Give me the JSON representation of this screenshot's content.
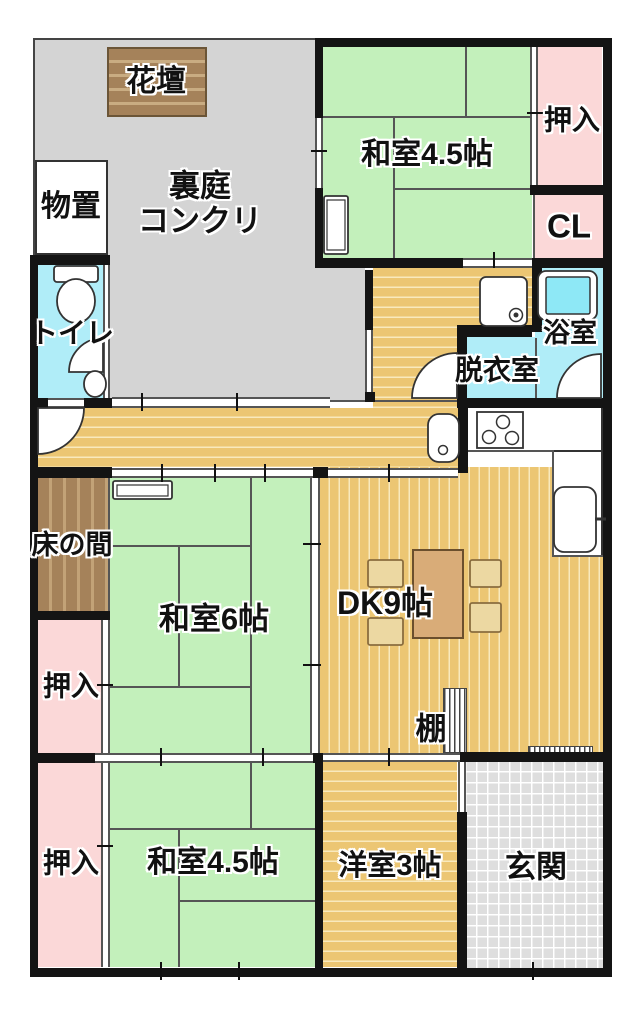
{
  "meta": {
    "type": "floor-plan",
    "description": "Japanese apartment floor plan"
  },
  "colors": {
    "tatami_green": "#c3f0bb",
    "closet_pink": "#fbd8d8",
    "wet_cyan": "#b0edf8",
    "wood_tan": "#ecc673",
    "wood_stripe": "#f9e9bd",
    "garden_gray": "#d4d4d4",
    "entry_gray": "#dedede",
    "alcove_brown": "#a5825a",
    "wall_black": "#141414",
    "table_brown": "#d9ac78",
    "chair_tan": "#ecd8a2"
  },
  "icons": [
    "toilet-icon",
    "hand-basin-icon",
    "door-arc-icon",
    "washbasin-icon",
    "stove-icon",
    "washing-machine-pan-icon",
    "bathtub-icon",
    "refrigerator-icon",
    "air-conditioner-icon",
    "dining-table-icon",
    "chair-icon",
    "shelf-icon"
  ],
  "rooms": [
    {
      "name": "backyard-area",
      "fill": "garden",
      "rect": [
        33,
        38,
        289,
        362
      ]
    },
    {
      "name": "backyard-area-east",
      "fill": "garden2",
      "rect": [
        322,
        268,
        43,
        132
      ]
    },
    {
      "name": "flower-bed",
      "fill": "bed",
      "rect": [
        107,
        47,
        100,
        70
      ]
    },
    {
      "name": "storage-shed",
      "fill": "white",
      "rect": [
        35,
        160,
        73,
        95
      ]
    },
    {
      "name": "toilet-room",
      "fill": "wet",
      "rect": [
        38,
        265,
        65,
        133
      ]
    },
    {
      "name": "laundry-area",
      "fill": "wood-h",
      "rect": [
        373,
        268,
        159,
        57
      ]
    },
    {
      "name": "kitchen-corridor",
      "fill": "wood-h",
      "rect": [
        373,
        268,
        84,
        140
      ]
    },
    {
      "name": "dressing-room",
      "fill": "wet",
      "rect": [
        467,
        337,
        68,
        61
      ]
    },
    {
      "name": "bathroom",
      "fill": "wet",
      "rect": [
        535,
        268,
        68,
        130
      ]
    },
    {
      "name": "hallway",
      "fill": "wood-h",
      "rect": [
        38,
        408,
        422,
        59
      ]
    },
    {
      "name": "dining-kitchen",
      "fill": "wood-v",
      "rect": [
        320,
        467,
        283,
        286
      ]
    },
    {
      "name": "kitchen-counter",
      "fill": "white",
      "rect": [
        466,
        406,
        137,
        46
      ]
    },
    {
      "name": "kitchen-counter-side",
      "fill": "white",
      "rect": [
        552,
        450,
        51,
        107
      ]
    },
    {
      "name": "japanese-room-45-top",
      "fill": "tatami",
      "rect": [
        323,
        47,
        209,
        211
      ]
    },
    {
      "name": "oshiire-top",
      "fill": "closet",
      "rect": [
        538,
        47,
        64,
        138
      ]
    },
    {
      "name": "cl-closet",
      "fill": "closet",
      "rect": [
        535,
        195,
        68,
        63
      ]
    },
    {
      "name": "tokonoma-alcove",
      "fill": "alcove",
      "rect": [
        38,
        478,
        70,
        133
      ]
    },
    {
      "name": "japanese-room-6",
      "fill": "tatami",
      "rect": [
        110,
        478,
        205,
        275
      ]
    },
    {
      "name": "oshiire-middle",
      "fill": "closet",
      "rect": [
        38,
        620,
        67,
        133
      ]
    },
    {
      "name": "oshiire-bottom",
      "fill": "closet",
      "rect": [
        38,
        762,
        67,
        205
      ]
    },
    {
      "name": "japanese-room-45-bottom",
      "fill": "tatami",
      "rect": [
        110,
        762,
        207,
        205
      ]
    },
    {
      "name": "western-room-3",
      "fill": "wood-h",
      "rect": [
        323,
        762,
        134,
        205
      ]
    },
    {
      "name": "entrance-hall",
      "fill": "entry",
      "rect": [
        465,
        760,
        138,
        208
      ]
    },
    {
      "name": "shelf-unit",
      "fill": "shelf",
      "rect": [
        443,
        688,
        24,
        65
      ]
    },
    {
      "name": "shelf-strip",
      "fill": "shelf",
      "rect": [
        528,
        746,
        65,
        8
      ]
    }
  ],
  "walls": [
    [
      315,
      38,
      297,
      9
    ],
    [
      603,
      38,
      9,
      939
    ],
    [
      30,
      968,
      582,
      9
    ],
    [
      30,
      255,
      8,
      722
    ],
    [
      30,
      255,
      80,
      10
    ],
    [
      30,
      398,
      18,
      10
    ],
    [
      84,
      398,
      28,
      10
    ],
    [
      30,
      467,
      82,
      11
    ],
    [
      313,
      467,
      15,
      11
    ],
    [
      30,
      611,
      80,
      9
    ],
    [
      30,
      753,
      65,
      10
    ],
    [
      313,
      753,
      10,
      10
    ],
    [
      460,
      752,
      143,
      10
    ],
    [
      315,
      38,
      8,
      80
    ],
    [
      315,
      188,
      8,
      70
    ],
    [
      315,
      258,
      148,
      10
    ],
    [
      532,
      258,
      80,
      10
    ],
    [
      530,
      185,
      73,
      10
    ],
    [
      532,
      268,
      10,
      64
    ],
    [
      457,
      325,
      75,
      12
    ],
    [
      457,
      337,
      10,
      63
    ],
    [
      458,
      398,
      10,
      75
    ],
    [
      457,
      398,
      146,
      10
    ],
    [
      365,
      270,
      8,
      60
    ],
    [
      365,
      392,
      10,
      10
    ],
    [
      315,
      762,
      8,
      206
    ],
    [
      457,
      812,
      10,
      156
    ]
  ],
  "bands": [
    {
      "dir": "v",
      "rect": [
        315,
        118,
        8,
        70
      ],
      "name": "window-west-top-room"
    },
    {
      "dir": "h",
      "rect": [
        463,
        258,
        69,
        10
      ],
      "name": "sliding-door-laundry"
    },
    {
      "dir": "v",
      "rect": [
        365,
        330,
        8,
        62
      ],
      "name": "sliding-door-backyard"
    },
    {
      "dir": "h",
      "rect": [
        112,
        397,
        218,
        11
      ],
      "name": "window-hallway-north"
    },
    {
      "dir": "h",
      "rect": [
        48,
        398,
        36,
        10
      ],
      "name": "toilet-door-gap"
    },
    {
      "dir": "h",
      "rect": [
        112,
        468,
        201,
        10
      ],
      "name": "sliding-door-room6-hall"
    },
    {
      "dir": "h",
      "rect": [
        328,
        468,
        130,
        10
      ],
      "name": "sliding-door-dk-hall"
    },
    {
      "dir": "v",
      "rect": [
        310,
        478,
        10,
        275
      ],
      "name": "sliding-door-room6-dk"
    },
    {
      "dir": "v",
      "rect": [
        530,
        47,
        8,
        138
      ],
      "name": "sliding-door-oshiire-top"
    },
    {
      "dir": "v",
      "rect": [
        101,
        620,
        9,
        133
      ],
      "name": "sliding-door-oshiire-mid"
    },
    {
      "dir": "v",
      "rect": [
        101,
        762,
        9,
        205
      ],
      "name": "sliding-door-oshiire-bottom"
    },
    {
      "dir": "h",
      "rect": [
        95,
        753,
        220,
        10
      ],
      "name": "sliding-door-rooms-south"
    },
    {
      "dir": "h",
      "rect": [
        323,
        753,
        137,
        9
      ],
      "name": "sliding-door-dk-western"
    },
    {
      "dir": "v",
      "rect": [
        458,
        762,
        8,
        50
      ],
      "name": "opening-western-entrance"
    },
    {
      "dir": "h",
      "rect": [
        112,
        968,
        205,
        9
      ],
      "name": "window-south"
    },
    {
      "dir": "h",
      "rect": [
        470,
        968,
        127,
        9
      ],
      "name": "entrance-door"
    },
    {
      "dir": "v",
      "rect": [
        103,
        265,
        7,
        133
      ],
      "name": "toilet-partition"
    }
  ],
  "tlines": [
    [
      466,
      450,
      86,
      2
    ],
    [
      552,
      450,
      2,
      107
    ],
    [
      552,
      555,
      51,
      2
    ],
    [
      466,
      406,
      2,
      46
    ],
    [
      535,
      338,
      2,
      60
    ],
    [
      108,
      478,
      2,
      133
    ],
    [
      533,
      195,
      2,
      63
    ],
    [
      330,
      400,
      128,
      2
    ],
    [
      323,
      116,
      209,
      2
    ],
    [
      465,
      47,
      2,
      69
    ],
    [
      393,
      116,
      2,
      142
    ],
    [
      393,
      188,
      139,
      2
    ],
    [
      250,
      478,
      2,
      275
    ],
    [
      110,
      545,
      140,
      2
    ],
    [
      178,
      545,
      2,
      141
    ],
    [
      110,
      686,
      140,
      2
    ],
    [
      110,
      828,
      207,
      2
    ],
    [
      250,
      762,
      2,
      66
    ],
    [
      178,
      828,
      2,
      139
    ],
    [
      178,
      900,
      139,
      2
    ]
  ],
  "ticks": [
    [
      141,
      393,
      2,
      18
    ],
    [
      236,
      393,
      2,
      18
    ],
    [
      161,
      464,
      2,
      18
    ],
    [
      214,
      464,
      2,
      18
    ],
    [
      264,
      464,
      2,
      18
    ],
    [
      388,
      464,
      2,
      18
    ],
    [
      493,
      252,
      2,
      16
    ],
    [
      311,
      150,
      16,
      2
    ],
    [
      527,
      112,
      16,
      2
    ],
    [
      303,
      543,
      18,
      2
    ],
    [
      303,
      664,
      18,
      2
    ],
    [
      97,
      684,
      16,
      2
    ],
    [
      97,
      845,
      16,
      2
    ],
    [
      160,
      748,
      2,
      18
    ],
    [
      262,
      748,
      2,
      18
    ],
    [
      388,
      748,
      2,
      18
    ],
    [
      160,
      962,
      2,
      18
    ],
    [
      238,
      962,
      2,
      18
    ],
    [
      532,
      962,
      2,
      18
    ]
  ],
  "labels": [
    {
      "name": "label-flower-bed",
      "text": "花壇",
      "x": 156,
      "y": 82,
      "fs": 30
    },
    {
      "name": "label-backyard",
      "text": "裏庭\nコンクリ",
      "x": 200,
      "y": 204,
      "fs": 31
    },
    {
      "name": "label-storage",
      "text": "物置",
      "x": 71,
      "y": 207,
      "fs": 30
    },
    {
      "name": "label-toilet",
      "text": "トイレ",
      "x": 72,
      "y": 333,
      "fs": 28
    },
    {
      "name": "label-japanese-room-45-top",
      "text": "和室4.5帖",
      "x": 427,
      "y": 155,
      "fs": 30
    },
    {
      "name": "label-oshiire-top",
      "text": "押入",
      "x": 572,
      "y": 120,
      "fs": 28
    },
    {
      "name": "label-cl",
      "text": "CL",
      "x": 569,
      "y": 227,
      "fs": 33
    },
    {
      "name": "label-bathroom",
      "text": "浴室",
      "x": 570,
      "y": 333,
      "fs": 27
    },
    {
      "name": "label-dressing-room",
      "text": "脱衣室",
      "x": 497,
      "y": 370,
      "fs": 28
    },
    {
      "name": "label-tokonoma",
      "text": "床の間",
      "x": 72,
      "y": 545,
      "fs": 27
    },
    {
      "name": "label-japanese-room-6",
      "text": "和室6帖",
      "x": 214,
      "y": 620,
      "fs": 31
    },
    {
      "name": "label-dk",
      "text": "DK9帖",
      "x": 385,
      "y": 604,
      "fs": 32
    },
    {
      "name": "label-shelf",
      "text": "棚",
      "x": 431,
      "y": 730,
      "fs": 31
    },
    {
      "name": "label-oshiire-middle",
      "text": "押入",
      "x": 71,
      "y": 686,
      "fs": 28
    },
    {
      "name": "label-oshiire-bottom",
      "text": "押入",
      "x": 71,
      "y": 863,
      "fs": 28
    },
    {
      "name": "label-japanese-room-45-bottom",
      "text": "和室4.5帖",
      "x": 213,
      "y": 863,
      "fs": 30
    },
    {
      "name": "label-western-room-3",
      "text": "洋室3帖",
      "x": 390,
      "y": 866,
      "fs": 29
    },
    {
      "name": "label-entrance",
      "text": "玄関",
      "x": 536,
      "y": 868,
      "fs": 31
    }
  ]
}
